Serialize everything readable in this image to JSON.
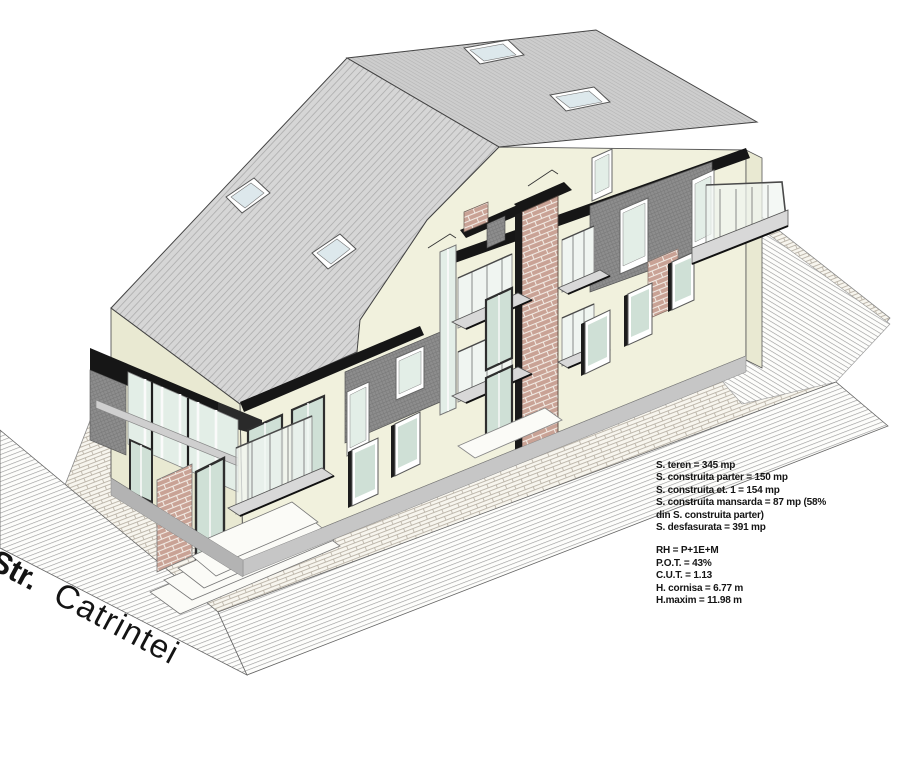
{
  "street_label": {
    "prefix": "Str.",
    "name": "Catrintei"
  },
  "stats_block": {
    "group1": [
      "S. teren = 345 mp",
      "S. construita parter = 150 mp",
      "S. construita et. 1 = 154 mp",
      "S. construita mansarda = 87 mp (58%",
      "din S. construita parter)",
      "S. desfasurata =  391 mp"
    ],
    "group2": [
      "RH =  P+1E+M",
      "P.O.T.  = 43%",
      "C.U.T.  = 1.13",
      "H. cornisa = 6.77 m",
      "H.maxim = 11.98 m"
    ]
  },
  "colors": {
    "wall": "#f1f1dd",
    "wallShade": "#e9e9d2",
    "roof": "#d6d6d6",
    "roofCap": "#cdcdcd",
    "mansard": "#8d8d8d",
    "fascia": "#161616",
    "brick": "#c9a295",
    "brickMortar": "#f2ebe4",
    "glass": "#e3eee7",
    "glassDark": "#cfe0d6",
    "glassPale": "#f0f5f1",
    "paving": "#f7f5ee",
    "pavingJoint": "#b7b0a4",
    "streetLine": "#9a9a9a",
    "plinth": "#c6c6c6",
    "outline": "#444444"
  }
}
